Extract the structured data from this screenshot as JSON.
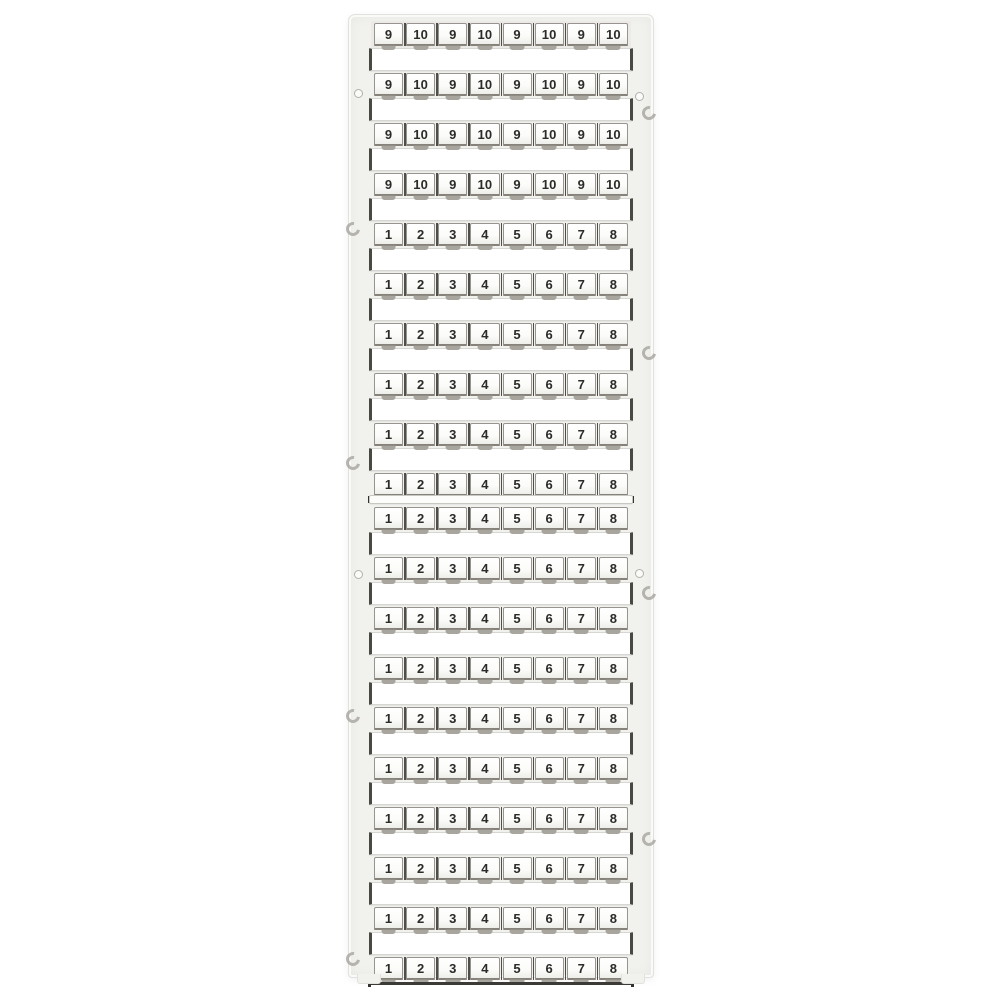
{
  "product": {
    "name": "terminal-block-marker-cards",
    "description": "Two white plastic marker cards in a vertical frame; each card holds rows of eight numbered marker tags with blank strips between rows, mounting holes and clip marks on the side rails.",
    "colors": {
      "background": "#ffffff",
      "frame": "#f1f1ee",
      "frame_edge": "#e1e1dd",
      "tag_face": "#fbfbf9",
      "tag_border": "#97948f",
      "divider": "#504e49",
      "number": "#2b2b28",
      "notch": "#a8a59e",
      "strip": "#ffffff",
      "strip_end": "#4a4843",
      "dark_line": "#3c3a36",
      "hole_ring": "#b3b0aa",
      "clip": "#aca9a3"
    },
    "cards": [
      {
        "id": "top-card",
        "top_edge": false,
        "rows": [
          [
            "9",
            "10",
            "9",
            "10",
            "9",
            "10",
            "9",
            "10"
          ],
          [
            "9",
            "10",
            "9",
            "10",
            "9",
            "10",
            "9",
            "10"
          ],
          [
            "9",
            "10",
            "9",
            "10",
            "9",
            "10",
            "9",
            "10"
          ],
          [
            "9",
            "10",
            "9",
            "10",
            "9",
            "10",
            "9",
            "10"
          ],
          [
            "1",
            "2",
            "3",
            "4",
            "5",
            "6",
            "7",
            "8"
          ],
          [
            "1",
            "2",
            "3",
            "4",
            "5",
            "6",
            "7",
            "8"
          ],
          [
            "1",
            "2",
            "3",
            "4",
            "5",
            "6",
            "7",
            "8"
          ],
          [
            "1",
            "2",
            "3",
            "4",
            "5",
            "6",
            "7",
            "8"
          ],
          [
            "1",
            "2",
            "3",
            "4",
            "5",
            "6",
            "7",
            "8"
          ],
          [
            "1",
            "2",
            "3",
            "4",
            "5",
            "6",
            "7",
            "8"
          ]
        ]
      },
      {
        "id": "bottom-card",
        "top_edge": true,
        "rows": [
          [
            "1",
            "2",
            "3",
            "4",
            "5",
            "6",
            "7",
            "8"
          ],
          [
            "1",
            "2",
            "3",
            "4",
            "5",
            "6",
            "7",
            "8"
          ],
          [
            "1",
            "2",
            "3",
            "4",
            "5",
            "6",
            "7",
            "8"
          ],
          [
            "1",
            "2",
            "3",
            "4",
            "5",
            "6",
            "7",
            "8"
          ],
          [
            "1",
            "2",
            "3",
            "4",
            "5",
            "6",
            "7",
            "8"
          ],
          [
            "1",
            "2",
            "3",
            "4",
            "5",
            "6",
            "7",
            "8"
          ],
          [
            "1",
            "2",
            "3",
            "4",
            "5",
            "6",
            "7",
            "8"
          ],
          [
            "1",
            "2",
            "3",
            "4",
            "5",
            "6",
            "7",
            "8"
          ],
          [
            "1",
            "2",
            "3",
            "4",
            "5",
            "6",
            "7",
            "8"
          ],
          [
            "1",
            "2",
            "3",
            "4",
            "5",
            "6",
            "7",
            "8"
          ]
        ]
      }
    ],
    "rail_features": [
      {
        "side": "left",
        "type": "hole",
        "y": 78
      },
      {
        "side": "left",
        "type": "clip",
        "y": 214
      },
      {
        "side": "left",
        "type": "clip",
        "y": 448
      },
      {
        "side": "left",
        "type": "hole",
        "y": 559
      },
      {
        "side": "left",
        "type": "clip",
        "y": 701
      },
      {
        "side": "left",
        "type": "clip",
        "y": 944
      },
      {
        "side": "right",
        "type": "hole",
        "y": 81
      },
      {
        "side": "right",
        "type": "clip",
        "y": 98
      },
      {
        "side": "right",
        "type": "clip",
        "y": 338
      },
      {
        "side": "right",
        "type": "hole",
        "y": 558
      },
      {
        "side": "right",
        "type": "clip",
        "y": 578
      },
      {
        "side": "right",
        "type": "clip",
        "y": 824
      }
    ]
  }
}
